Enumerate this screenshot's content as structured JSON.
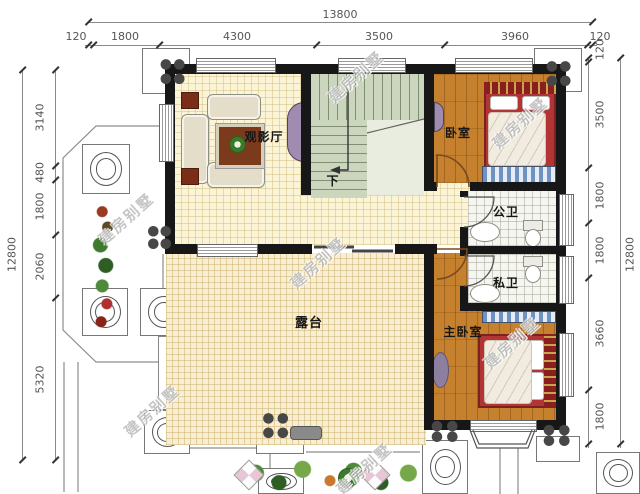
{
  "watermark": {
    "text": "建房别墅"
  },
  "dimensions": {
    "top": {
      "total": "13800",
      "segments": [
        "120",
        "1800",
        "4300",
        "3500",
        "3960",
        "120"
      ]
    },
    "left": {
      "total": "12800",
      "segments": [
        "3140",
        "480",
        "1800",
        "2060",
        "5320"
      ]
    },
    "right": {
      "total": "12800",
      "segments": [
        "120",
        "3500",
        "1800",
        "1800",
        "3660",
        "1800"
      ]
    }
  },
  "rooms": {
    "theater": {
      "label": "观影厅"
    },
    "bedroom": {
      "label": "卧室"
    },
    "public_bath": {
      "label": "公卫"
    },
    "private_bath": {
      "label": "私卫"
    },
    "master": {
      "label": "主卧室"
    },
    "terrace": {
      "label": "露台"
    },
    "stairs_down": {
      "label": "下"
    }
  },
  "colors": {
    "wall": "#171717",
    "wood_floor": "#c6812f",
    "hall_floor": "#fbf4d7",
    "terrace_floor": "#f8efd2",
    "stair": "#ccd5bd",
    "accent_purple": "#a08cb0",
    "bed_red": "#b23434",
    "wardrobe_blue": "#6f93c0"
  }
}
